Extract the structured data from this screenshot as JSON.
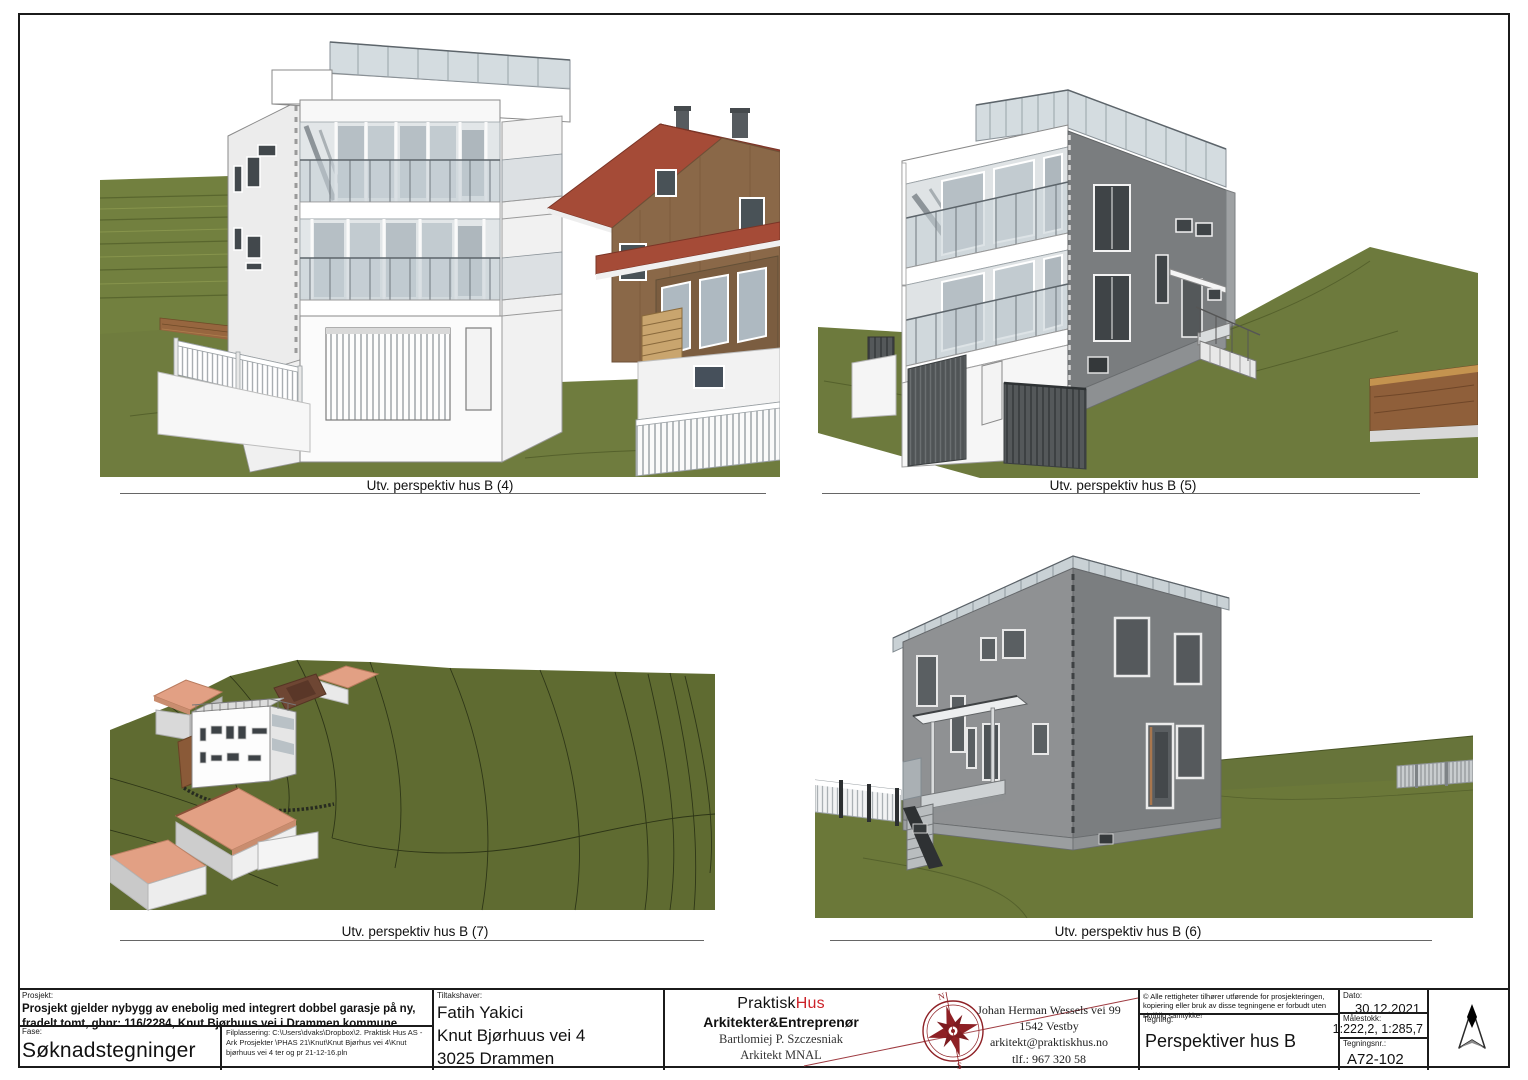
{
  "figures": [
    {
      "caption": "Utv. perspektiv hus B (4)"
    },
    {
      "caption": "Utv. perspektiv hus B (5)"
    },
    {
      "caption": "Utv. perspektiv hus B (7)"
    },
    {
      "caption": "Utv. perspektiv hus B (6)"
    }
  ],
  "title_block": {
    "prosjekt_label": "Prosjekt:",
    "prosjekt_text": "Prosjekt gjelder nybygg av enebolig med integrert dobbel garasje på ny, fradelt tomt, gbnr: 116/2284, Knut Bjørhuus vei i Drammen kommune.",
    "fase_label": "Fase:",
    "fase_value": "Søknadstegninger",
    "filplassering": "Filplassering: C:\\Users\\dvaks\\Dropbox\\2. Praktisk Hus AS - Ark Prosjekter \\PHAS 21\\Knut\\Knut Bjørhus vei 4\\Knut bjørhuus vei 4 ter og pr 21-12-16.pln",
    "tiltakshaver_label": "Tiltakshaver:",
    "tiltakshaver_name": "Fatih Yakici",
    "tiltakshaver_addr1": "Knut Bjørhuus vei 4",
    "tiltakshaver_addr2": "3025 Drammen",
    "firm_name_black": "Praktisk",
    "firm_name_red": "Hus",
    "firm_tagline": "Arkitekter&Entreprenør",
    "architect_name": "Bartlomiej P. Szczesniak",
    "architect_title": "Arkitekt MNAL",
    "contact_addr1": "Johan Herman Wessels vei 99",
    "contact_addr2": "1542 Vestby",
    "contact_email": "arkitekt@praktiskhus.no",
    "contact_phone": "tlf.: 967 320 58",
    "copyright": "© Alle rettigheter tilhører utførende for prosjekteringen, kopiering eller bruk av disse tegningene er forbudt uten skriftlig samtykke!",
    "tegning_label": "Tegning:",
    "tegning_value": "Perspektiver hus B",
    "dato_label": "Dato:",
    "dato_value": "30.12.2021",
    "malestokk_label": "Målestokk:",
    "malestokk_value": "1:222,2, 1:285,7",
    "tegningsnr_label": "Tegningsnr.:",
    "tegningsnr_value": "A72-102",
    "compass_n": "N",
    "compass_s": "S"
  },
  "palette": {
    "grass": "#6f7c3e",
    "grass_dark": "#5f6b31",
    "roof_red": "#a54b37",
    "roof_salmon": "#e2a084",
    "wood_wall": "#8a6848",
    "retaining_wall_brown": "#8f5f3a",
    "house_gray": "#7b7e80",
    "house_white": "#f6f6f6",
    "glass": "#c7d0d6",
    "brand_red": "#cc2229",
    "compass_red": "#8e2025",
    "line_black": "#1b1b1b"
  }
}
